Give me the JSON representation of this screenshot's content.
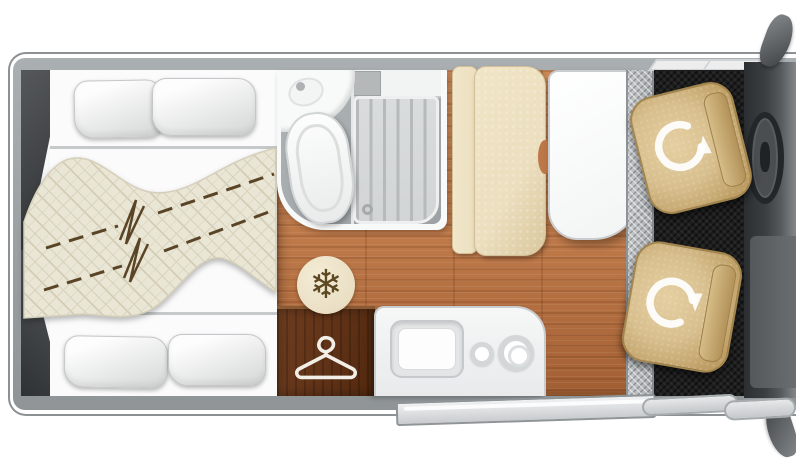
{
  "page": {
    "title": "Campervan floor plan",
    "view": "top-down layout diagram",
    "text_visible": "none"
  },
  "icons": {
    "snowflake": {
      "glyph": "❄",
      "meaning": "refrigerator position"
    },
    "hanger": {
      "meaning": "wardrobe position"
    },
    "swivel_arrow": {
      "meaning": "rotating cab seat",
      "count": 2
    }
  },
  "rooms": {
    "rear_bedroom": {
      "beds": 2,
      "pillows": 4,
      "duvet": "quilted with dashed fold lines and break marks"
    },
    "bathroom": {
      "fixtures": [
        "corner washbasin",
        "toilet",
        "shower tray with slats and drain"
      ]
    },
    "galley": {
      "fixtures": [
        "sink",
        "small burner",
        "large burner"
      ],
      "units": [
        "wardrobe",
        "fridge"
      ]
    },
    "dinette": {
      "bench_seats": 1,
      "tables": 1
    },
    "cab": {
      "swivel_seats": 2,
      "steering_wheel": 1,
      "wing_mirrors": 2
    },
    "entry": {
      "step": "checker plate strip",
      "sliding_door": "open, shown outside body"
    }
  },
  "colors": {
    "wall-gray": "#8f9497",
    "wall-hi": "#aaafb2",
    "interior-white": "#f6f7f7",
    "wood": "#bd7848",
    "wood-hi": "#cd8a58",
    "wood-dark": "#a25f33",
    "wardrobe-wood": "#6e3d20",
    "wardrobe-wood-dark": "#53290f",
    "quilt": "#eae6d6",
    "quilt-line": "#cfc8ae",
    "dash-brown": "#5a4426",
    "pillow-hi": "#fdfdfd",
    "pillow-sh": "#d7d8d8",
    "bath-floor": "#9da2a4",
    "fixture-white": "#f8f9f9",
    "shower-tray": "#d2d5d6",
    "shower-rib": "#b6babb",
    "bench-beige": "#ecdfbf",
    "bench-beige-dark": "#d9c79c",
    "table-white": "#f2f4f4",
    "step-silver": "#a9adb0",
    "carpet-black": "#1e1e1e",
    "seat-tan": "#d8bf8e",
    "seat-tan-dark": "#bd9d63",
    "dash-gray": "#3a3e41",
    "dash-gray-light": "#84888b",
    "mirror-gray": "#3f4245",
    "door-panel": "#c9ccce",
    "kitchen-white": "#e8eaeb",
    "sink-gray": "#e3e5e6",
    "icon-brown": "#5e4a22",
    "icon-circle": "#eadfc4",
    "hanger-white": "#f2efe8"
  }
}
